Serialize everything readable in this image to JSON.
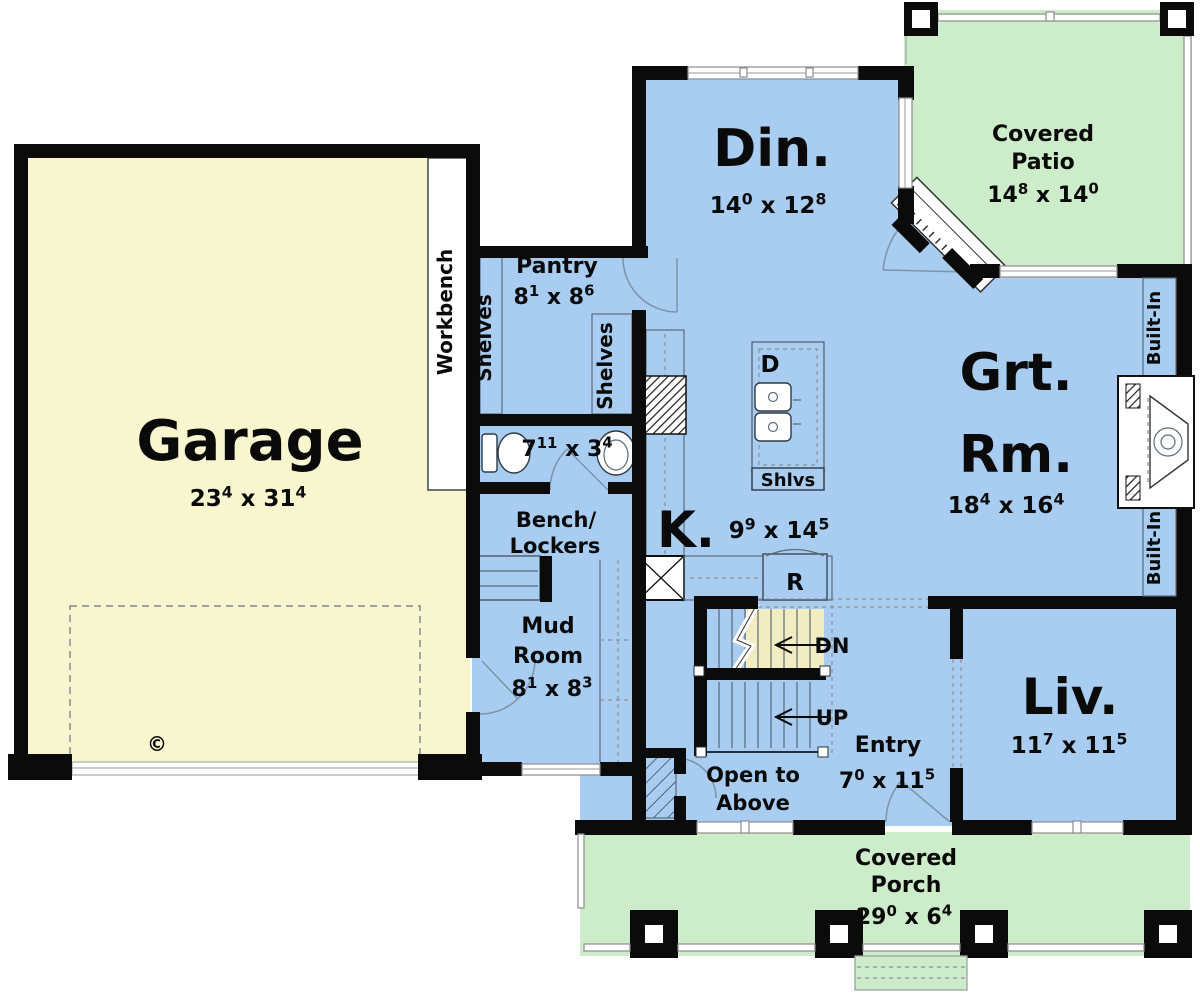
{
  "plan": {
    "rooms": {
      "garage": {
        "name": "Garage",
        "dims": "23^4 x 31^4"
      },
      "dining": {
        "name": "Din.",
        "dims": "14^0 x 12^8"
      },
      "covered_patio": {
        "name_line1": "Covered",
        "name_line2": "Patio",
        "dims": "14^8 x 14^0"
      },
      "great_room": {
        "name_line1": "Grt.",
        "name_line2": "Rm.",
        "dims": "18^4 x 16^4"
      },
      "kitchen": {
        "name": "K.",
        "dims": "9^9 x 14^5"
      },
      "living": {
        "name": "Liv.",
        "dims": "11^7 x 11^5"
      },
      "entry": {
        "name": "Entry",
        "dims": "7^0 x 11^5"
      },
      "mud_room": {
        "name_line1": "Mud",
        "name_line2": "Room",
        "dims": "8^1 x 8^3"
      },
      "pantry": {
        "name": "Pantry",
        "dims": "8^1 x 8^6"
      },
      "bath": {
        "dims": "7^11 x 3^4"
      },
      "covered_porch": {
        "name_line1": "Covered",
        "name_line2": "Porch",
        "dims": "29^0 x 6^4"
      }
    },
    "labels": {
      "workbench": "Workbench",
      "shelves_left": "Shelves",
      "shelves_right": "Shelves",
      "built_in_upper": "Built-In",
      "built_in_lower": "Built-In",
      "bench_line1": "Bench/",
      "bench_line2": "Lockers",
      "open_above_line1": "Open to",
      "open_above_line2": "Above",
      "stairs_down": "DN",
      "stairs_up": "UP",
      "dishwasher": "D",
      "refrigerator": "R",
      "island_shelves": "Shlvs",
      "copyright": "©"
    },
    "colors": {
      "interior_floor": "#A9CDF0",
      "garage_floor": "#F8F6CE",
      "outdoor_floor": "#CDEDCA",
      "stair_accent": "#F2ECC2",
      "wall": "#0B0B0B"
    }
  }
}
